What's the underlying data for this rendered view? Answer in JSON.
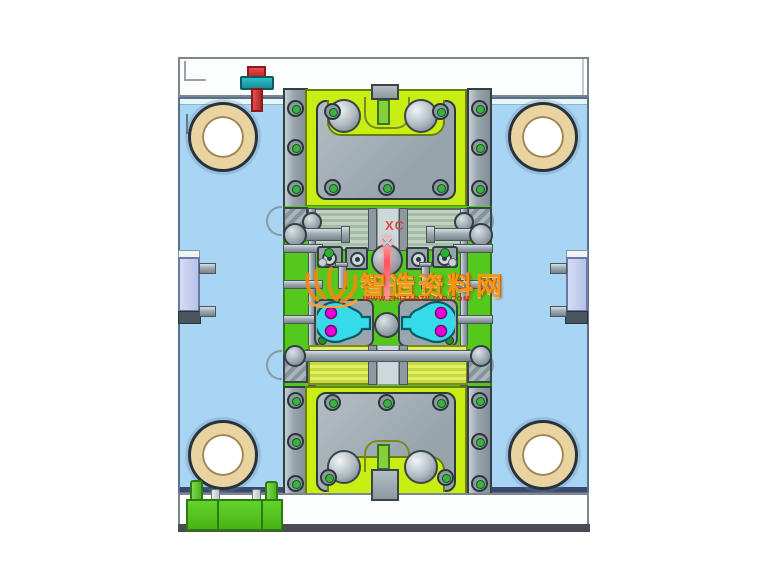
{
  "labels": {
    "datum_label": "XC",
    "cross_glyph": "✕"
  },
  "watermark": {
    "title": "智造资料网",
    "subtitle": "WWW.ZHIZAOZILIAO.COM"
  },
  "colors": {
    "base_plate_blue": "#a8d5f4",
    "plate_chartreuse": "#c9ee13",
    "core_green": "#55c81e",
    "machined_gray": "#9aa6ad",
    "insert_cyan": "#30d8e8",
    "insert_dot_magenta": "#ea00d5",
    "locating_ring_bronze": "#e9d3a1",
    "bolt_red": "#d43232",
    "bolt_washer_teal": "#1fa3ab",
    "support_lavender": "#c4cdee",
    "sprue_pink": "#ff7a7a",
    "datum_label_red": "#e04545",
    "watermark_orange": "#ff9414",
    "watermark_sub_red": "#e02020"
  }
}
